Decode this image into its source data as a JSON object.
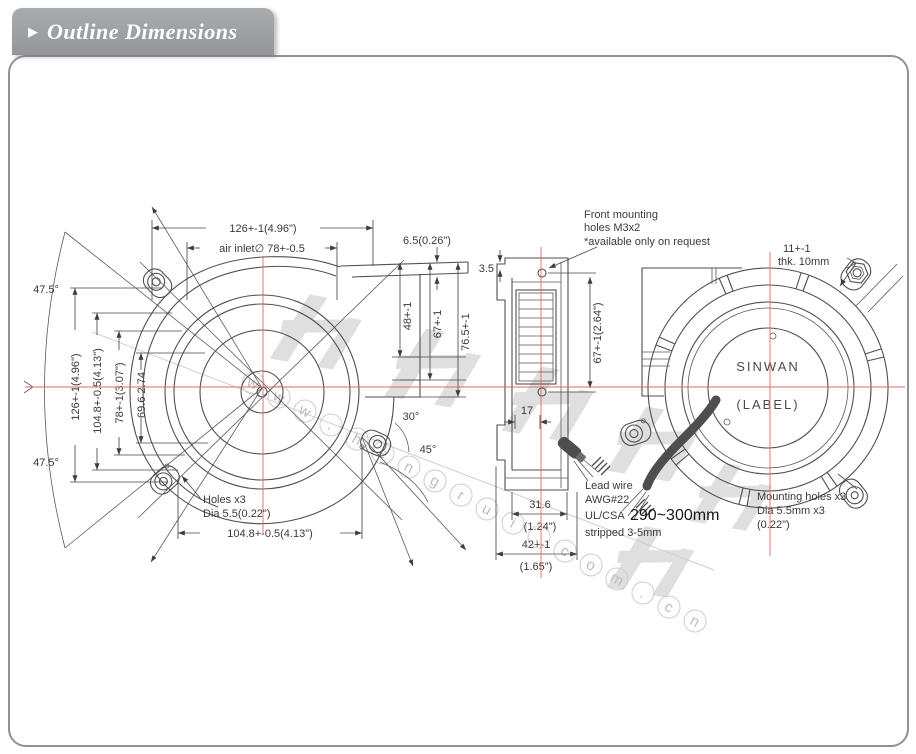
{
  "header": {
    "bullet": "▶",
    "title": "Outline Dimensions"
  },
  "watermark": {
    "cjk": "恒瑞宏晟机电",
    "url_letters": "www.hengrui.com.cn"
  },
  "front_view": {
    "dim_width_top": "126+-1(4.96\")",
    "dim_air_inlet": "air inlet∅ 78+-0.5",
    "dim_lip": "6.5(0.26\")",
    "dim_height": "126+-1(4.96\")",
    "dim_hole_span_v": "104.8+-0.5(4.13\")",
    "dim_78": "78+-1(3.07\")",
    "dim_696": "69.6 2.74",
    "angle_top": "47.5°",
    "angle_bottom": "47.5°",
    "angle_30": "30°",
    "angle_45": "45°",
    "holes_note_1": "Holes x3",
    "holes_note_2": "Dia 5.5(0.22\")",
    "dim_hole_span_h": "104.8+-0.5(4.13\")"
  },
  "side_view": {
    "dim_lip_offset": "3.5",
    "dim_48": "48+-1",
    "dim_67": "67+-1",
    "dim_765": "76.5+-1",
    "dim_hole_pitch": "67+-1(2.64\")",
    "dim_17": "17",
    "dim_316_mm": "31.6",
    "dim_316_in": "(1.24\")",
    "dim_42_mm": "42+-1",
    "dim_42_in": "(1.65\")",
    "front_mounting_note": [
      "Front mounting",
      "holes M3x2",
      "*available only on request"
    ]
  },
  "rear_view": {
    "dim_ear": "11+-1",
    "dim_thk": "thk. 10mm",
    "label_brand": "SINWAN",
    "label_label": "(LABEL)",
    "mounting_note": [
      "Mounting holes x3",
      "Dia 5.5mm x3",
      "(0.22\")"
    ]
  },
  "lead_wire_note": {
    "line1": "Lead wire",
    "line2": "AWG#22",
    "line3_prefix": "UL/CSA",
    "line3_big": "290~300mm",
    "line4": "stripped 3-5mm"
  }
}
